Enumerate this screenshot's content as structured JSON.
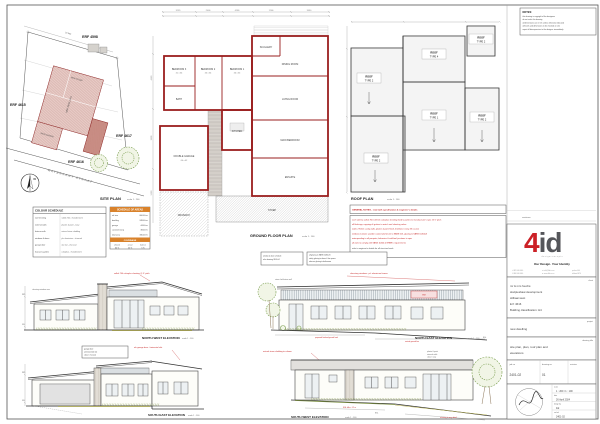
{
  "labels": {
    "scale_200": "scale 1 : 200",
    "scale_100": "scale 1 : 100",
    "north": "N"
  },
  "notes_box": {
    "title": "NOTES:",
    "lines": [
      "this drawing is copyright of the designers",
      "do not scale this drawing",
      "all dimensions are in mm unless otherwise indicated",
      "all levels and dimensions to be checked on site",
      "report all discrepancies to the designer immediately"
    ]
  },
  "site_plan": {
    "title": "SITE PLAN",
    "erf_top": "ERF 4598",
    "erf_left": "ERF 4615",
    "erf_right": "ERF 4617",
    "erf_main": "ERF 4616",
    "street": "WATERKANT STRAAT",
    "dim_top": "33 980",
    "label_stoep": "NEW STOEP",
    "label_dwelling": "NEW DWELLING",
    "label_garage": "NEW GARAGE"
  },
  "colour_schedule": {
    "title": "COLOUR SCHEDULE",
    "rows": [
      [
        "roof sheeting",
        "saflok 700 - thunderstorm"
      ],
      [
        "external walls",
        "plaster & paint - ivory"
      ],
      [
        "feature walls",
        "natural stone cladding"
      ],
      [
        "windows & doors",
        "p/c aluminium - charcoal"
      ],
      [
        "garage door",
        "alu slat - charcoal"
      ],
      [
        "fascias & gutters",
        "colorplus - thunderstorm"
      ]
    ]
  },
  "areas_schedule": {
    "title": "SCHEDULE OF AREAS",
    "rows": [
      [
        "erf size",
        "600.00 m²"
      ],
      [
        "dwelling",
        "248.00 m²"
      ],
      [
        "garage",
        "44.00 m²"
      ],
      [
        "covered stoep",
        "38.00 m²"
      ],
      [
        "total area",
        "330.00 m²"
      ]
    ],
    "coverage_title": "COVERAGE",
    "coverage_head": [
      "allowed",
      "actual",
      "balance"
    ],
    "coverage_vals": [
      "60 %",
      "55 %",
      "5 %"
    ]
  },
  "floor_plan": {
    "title": "GROUND FLOOR PLAN",
    "dims_top": [
      "3 970",
      "2 400",
      "4 180",
      "1 900",
      "3 610"
    ],
    "dims_left": [
      "4 950",
      "3 600",
      "5 250"
    ],
    "rooms": [
      {
        "n": "BEDROOM 3",
        "s": "3.1 x 3.6"
      },
      {
        "n": "BEDROOM 2",
        "s": "3.3 x 3.6"
      },
      {
        "n": "BEDROOM 1",
        "s": "3.6 x 3.3"
      },
      {
        "n": "BATH",
        "s": ""
      },
      {
        "n": "SCULLERY",
        "s": ""
      },
      {
        "n": "DINING ROOM",
        "s": ""
      },
      {
        "n": "LIVING ROOM",
        "s": ""
      },
      {
        "n": "MAIN BEDROOM",
        "s": ""
      },
      {
        "n": "ENSUITE",
        "s": ""
      },
      {
        "n": "KITCHEN",
        "s": ""
      },
      {
        "n": "DOUBLE GARAGE",
        "s": "6.0 x 6.2"
      },
      {
        "n": "STOEP",
        "s": ""
      },
      {
        "n": "DRIVEWAY",
        "s": ""
      }
    ]
  },
  "roof_plan": {
    "title": "ROOF PLAN",
    "areas": [
      {
        "a": "ROOF",
        "b": "TYPE 2"
      },
      {
        "a": "ROOF",
        "b": "TYPE 4"
      },
      {
        "a": "ROOF",
        "b": "TYPE 2"
      },
      {
        "a": "ROOF",
        "b": "TYPE 1"
      },
      {
        "a": "ROOF",
        "b": "TYPE 2"
      },
      {
        "a": "ROOF",
        "b": "TYPE 2"
      }
    ]
  },
  "general_notes": {
    "header": "GENERAL NOTES  -  read with specification & engineer's details",
    "lines": [
      "roof: safintra saflok 700 0.53mm colorplus sheeting fixed to purlins to manufacturer's spec @ 5° pitch",
      "all flashings, cappings & gutters to match roof sheeting colour",
      "walls: 270mm cavity walls, plaster & paint finish, brickforce every 4th course",
      "windows & doors: powder coated aluminium to SANS 613, glazing to SANS 10400-N",
      "waterproofing to all parapets, balconies & wall/roof junctions to spec",
      "all work to comply with SANS 10400 & NHBRC requirements"
    ],
    "footer": "refer to engineer's details for all structural work"
  },
  "elevations": {
    "nw": {
      "title": "NORTH WEST ELEVATION",
      "red_note": "saflok 700 colorplus sheeting @ 5° pitch",
      "note": "clerestory windows over"
    },
    "ne": {
      "title": "NORTH EAST ELEVATION",
      "red_note": "clerestory windows - p/c aluminium frames",
      "box1": [
        "window & door schedule",
        "refer drawing 2401-04"
      ],
      "box2": [
        "all glazing to SANS 10400-N",
        "safety glazing to doors & low panes",
        "obscure glazing to bathrooms"
      ],
      "red_box": "W09",
      "red_dim1": "proposed finished ground level",
      "red_dim2": "natural ground line",
      "note": "stone clad feature wall"
    },
    "se": {
      "title": "SOUTH EAST ELEVATION",
      "red_note": "alu garage door - horizontal slat",
      "box": [
        "garage door:",
        "alu horizontal slat",
        "colour: charcoal"
      ]
    },
    "sw": {
      "title": "SOUTH WEST ELEVATION",
      "red_note": "natural stone cladding to column",
      "notes": [
        "plaster & paint",
        "external walls",
        "colour: ivory"
      ],
      "red_dim1": "NGL falls ± 1.2 m",
      "red_dim2": "retaining to eng. detail"
    }
  },
  "levels": {
    "wpl": "WPL",
    "ffl": "FFL",
    "ngl": "NGL"
  },
  "title_block": {
    "revisions_label": "revisions",
    "logo": {
      "four": "4",
      "id": "id",
      "sub": "d e s i g n   c o n c e p t s",
      "tagline": "Our Design. Your Identity",
      "c1a": "t: 082 000 0000",
      "c1b": "f: 086 000 0000",
      "c2a": "e: info@4id.co.za",
      "c2b": "w: www.4id.co.za",
      "c3a": "po box 000",
      "c3b": "stilbaai 6674"
    },
    "client_label": "client",
    "client": [
      "mr & mrs fouché",
      "skulpiesbaai development",
      "stilbaai west",
      "Erf: 4616",
      "Building classification: H4"
    ],
    "project_label": "project",
    "project": "new dwelling",
    "drawing_title_label": "drawing title",
    "drawing_title_1": "site plan, plan, roof plan and",
    "drawing_title_2": "elevations",
    "job_no_label": "job no",
    "job_no": "2401-02",
    "drawing_no_label": "drawing no",
    "drawing_no": "01",
    "revision_label": "revision",
    "revision": "",
    "scale_label": "scale",
    "scale_val": "1 : 200 / 1 : 100",
    "date_label": "date",
    "date_val": "26 April 2024",
    "design_label": "design by",
    "design_val": "4id",
    "cadref_label": "cad ref",
    "cadref_val": "2401-02"
  }
}
